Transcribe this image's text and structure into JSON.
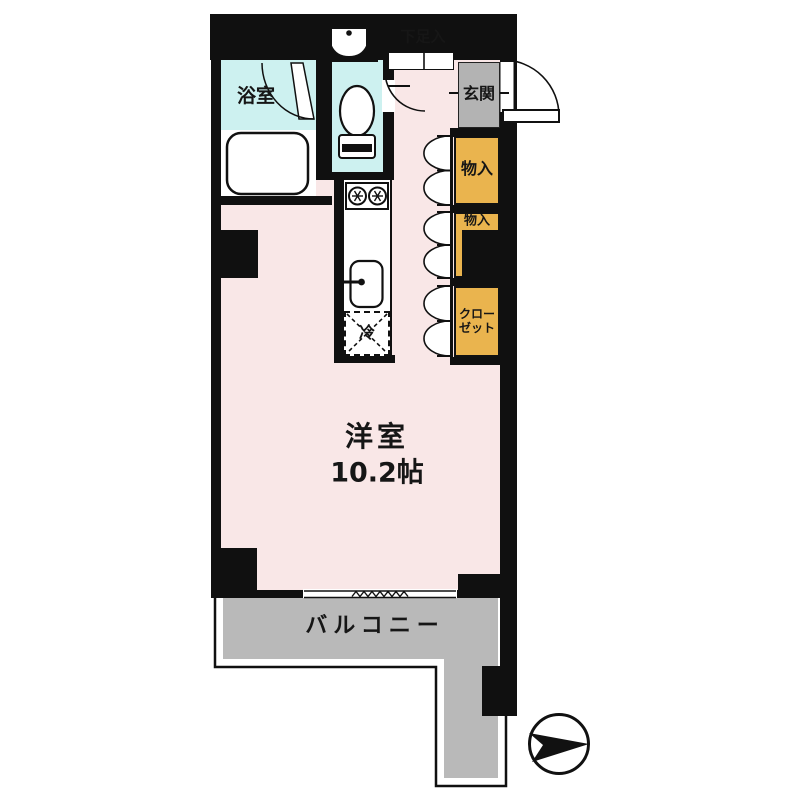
{
  "floorplan": {
    "title": "apartment-floor-plan",
    "labels": {
      "bathroom": "浴室",
      "shoe_box": "下足入",
      "entrance": "玄関",
      "storage_1": "物入",
      "storage_2": "物入",
      "closet_line1": "クロー",
      "closet_line2": "ゼット",
      "fridge": "冷",
      "main_room_name": "洋室",
      "main_room_size": "10.2帖",
      "balcony": "バルコニー"
    },
    "compass": {
      "icon": "north-arrow-icon",
      "points": "right"
    },
    "colors": {
      "room_pink": "#f9e7e7",
      "wet_cyan": "#cdf1f0",
      "storage_orange": "#eab44e",
      "entrance_gray": "#b3b3b3",
      "balcony_gray": "#b9b9b9",
      "wall_black": "#101010"
    }
  }
}
